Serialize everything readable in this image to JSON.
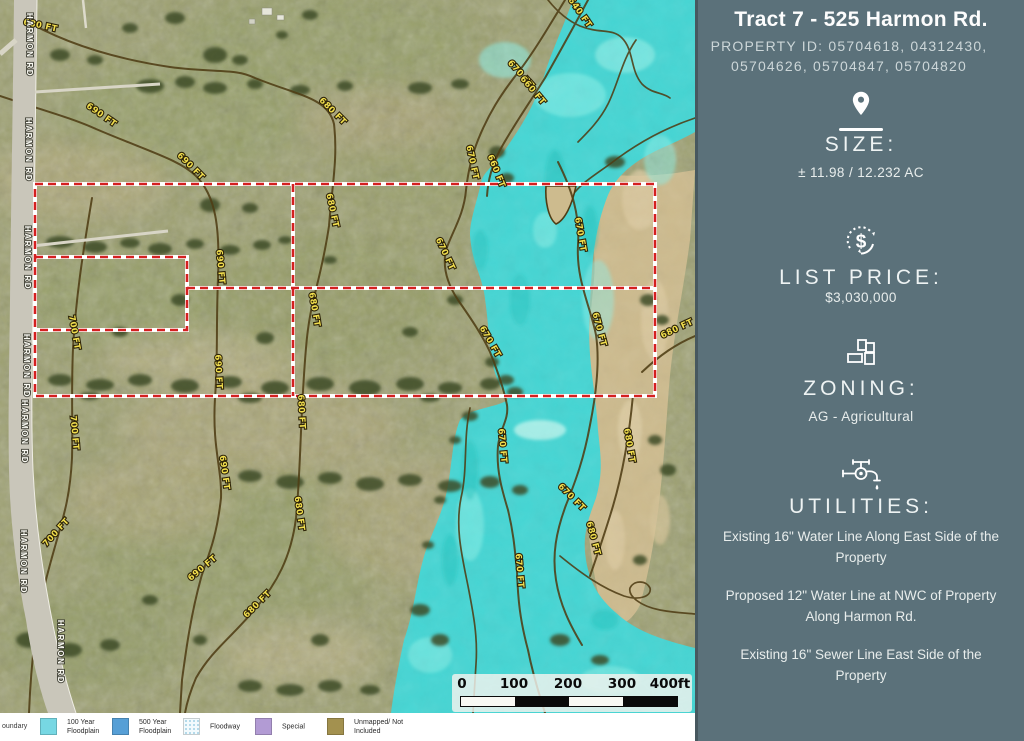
{
  "sidebar": {
    "title": "Tract 7 - 525 Harmon Rd.",
    "property_id": "PROPERTY ID: 05704618, 04312430, 05704626, 05704847, 05704820",
    "size_label": "SIZE:",
    "size_value": "± 11.98 / 12.232 AC",
    "list_price_label": "LIST PRICE:",
    "list_price_value": "$3,030,000",
    "zoning_label": "ZONING:",
    "zoning_value": "AG - Agricultural",
    "utilities_label": "UTILITIES:",
    "utilities_items": [
      "Existing 16\" Water Line Along East Side of the Property",
      "Proposed 12\" Water Line at NWC of Property Along Harmon Rd.",
      "Existing 16\" Sewer Line East Side of the Property"
    ],
    "dollar_glyph": "$",
    "colors": {
      "background": "#5b717a",
      "text": "#ffffff",
      "muted_text": "#ccd6d8"
    }
  },
  "map": {
    "road_name": "HARMON RD",
    "road_label_positions": [
      {
        "x": 27,
        "y": 45
      },
      {
        "x": 26,
        "y": 150
      },
      {
        "x": 25,
        "y": 258
      },
      {
        "x": 24,
        "y": 366
      },
      {
        "x": 22,
        "y": 432
      },
      {
        "x": 21,
        "y": 562
      },
      {
        "x": 58,
        "y": 652
      }
    ],
    "contour_labels": [
      {
        "t": "680 FT",
        "x": 40,
        "y": 28,
        "r": 12
      },
      {
        "t": "680 FT",
        "x": 331,
        "y": 113,
        "r": 45
      },
      {
        "t": "680 FT",
        "x": 330,
        "y": 211,
        "r": 78
      },
      {
        "t": "680 FT",
        "x": 312,
        "y": 310,
        "r": 80
      },
      {
        "t": "680 FT",
        "x": 299,
        "y": 412,
        "r": 87
      },
      {
        "t": "680 FT",
        "x": 297,
        "y": 514,
        "r": 82
      },
      {
        "t": "680 FT",
        "x": 259,
        "y": 606,
        "r": -45
      },
      {
        "t": "690 FT",
        "x": 100,
        "y": 117,
        "r": 35
      },
      {
        "t": "690 FT",
        "x": 189,
        "y": 168,
        "r": 45
      },
      {
        "t": "690 FT",
        "x": 218,
        "y": 267,
        "r": 85
      },
      {
        "t": "690 FT",
        "x": 216,
        "y": 372,
        "r": 87
      },
      {
        "t": "690 FT",
        "x": 222,
        "y": 473,
        "r": 82
      },
      {
        "t": "690 FT",
        "x": 204,
        "y": 570,
        "r": -40
      },
      {
        "t": "700 FT",
        "x": 72,
        "y": 333,
        "r": 80
      },
      {
        "t": "700 FT",
        "x": 72,
        "y": 433,
        "r": 85
      },
      {
        "t": "700 FT",
        "x": 58,
        "y": 534,
        "r": -48
      },
      {
        "t": "640 FT",
        "x": 578,
        "y": 14,
        "r": 55
      },
      {
        "t": "670 FT",
        "x": 519,
        "y": 76,
        "r": 48
      },
      {
        "t": "660 FT",
        "x": 531,
        "y": 92,
        "r": 50
      },
      {
        "t": "670 FT",
        "x": 470,
        "y": 163,
        "r": 78
      },
      {
        "t": "660 FT",
        "x": 494,
        "y": 172,
        "r": 68
      },
      {
        "t": "670 FT",
        "x": 443,
        "y": 255,
        "r": 65
      },
      {
        "t": "670 FT",
        "x": 488,
        "y": 343,
        "r": 60
      },
      {
        "t": "670 FT",
        "x": 578,
        "y": 235,
        "r": 80
      },
      {
        "t": "670 FT",
        "x": 597,
        "y": 330,
        "r": 75
      },
      {
        "t": "680 FT",
        "x": 678,
        "y": 331,
        "r": -25
      },
      {
        "t": "670 FT",
        "x": 500,
        "y": 446,
        "r": 85
      },
      {
        "t": "670 FT",
        "x": 517,
        "y": 571,
        "r": 85
      },
      {
        "t": "670 FT",
        "x": 570,
        "y": 499,
        "r": 45
      },
      {
        "t": "680 FT",
        "x": 627,
        "y": 446,
        "r": 80
      },
      {
        "t": "680 FT",
        "x": 591,
        "y": 539,
        "r": 75
      }
    ],
    "scale_bar": {
      "ticks": [
        "0",
        "100",
        "200",
        "300",
        "400ft"
      ]
    },
    "legend": {
      "partial_label": "oundary",
      "items": [
        {
          "label": "100 Year Floodplain",
          "swatch": "#77d7e3",
          "style": "solid",
          "x": 40
        },
        {
          "label": "500 Year Floodplain",
          "swatch": "#569fd6",
          "style": "solid",
          "x": 112
        },
        {
          "label": "Floodway",
          "swatch": "#bfe3f0",
          "style": "hatch",
          "x": 183
        },
        {
          "label": "Special",
          "swatch": "#b29bd4",
          "style": "solid",
          "x": 255
        },
        {
          "label": "Unmapped/ Not Included",
          "swatch": "#a3914f",
          "style": "solid",
          "x": 327
        }
      ]
    },
    "colors": {
      "floodplain": "#45d6d4",
      "terrain": "#9da06e",
      "bare_soil": "#cdbb8e",
      "contour": "#4f3d15",
      "contour_text": "#f2df4e",
      "boundary": "#d42020",
      "road": "#c9c6ba"
    }
  }
}
